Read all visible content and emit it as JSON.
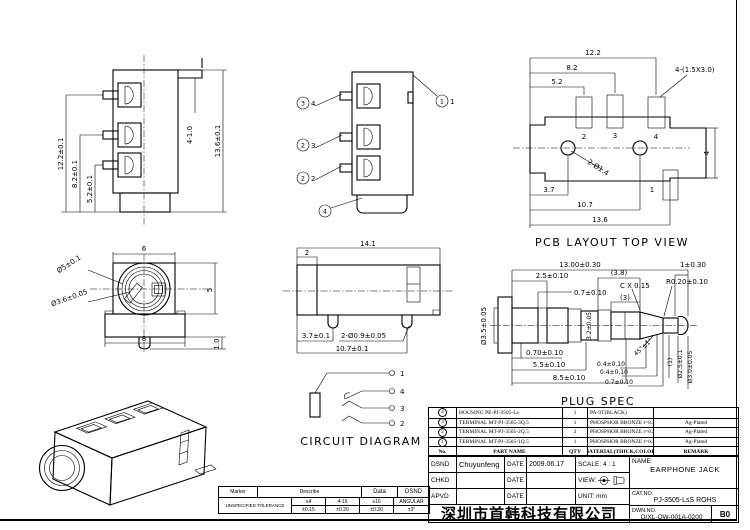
{
  "views": {
    "left": {
      "d_12_2": "12.2±0.1",
      "d_8_2": "8.2±0.1",
      "d_5_2": "5.2±0.1",
      "d_4_1": "4-1.0",
      "d_13_6": "13.6±0.1"
    },
    "open": {
      "pin_top_circle": "3",
      "pin_top": "4",
      "pin_mid_circle": "2",
      "pin_mid": "3",
      "pin_bot_circle": "2",
      "pin_bot": "2",
      "pin_housing_circle": "4",
      "pin_sleeve_circle": "1",
      "pin_sleeve": "1"
    },
    "pcb": {
      "title": "PCB LAYOUT TOP VIEW",
      "d_12_2": "12.2",
      "d_8_2": "8.2",
      "d_5_2": "5.2",
      "slot_note": "4-(1.5X3.0)",
      "hole_note": "2-Ø1.4",
      "d_4": "4",
      "d_3_7": "3.7",
      "d_10_7": "10.7",
      "d_13_6": "13.6",
      "pad_2": "2",
      "pad_3": "3",
      "pad_4": "4",
      "pad_1": "1"
    },
    "front": {
      "d_6": "6",
      "d_8": "8",
      "d_dia5": "Ø5±0.1",
      "d_dia36": "Ø3.6±0.05",
      "d_5": "5",
      "d_1": "1.0"
    },
    "side": {
      "d_14_1": "14.1",
      "d_2": "2",
      "d_3_7": "3.7±0.1",
      "d_holes": "2-Ø0.9±0.05",
      "d_10_7": "10.7±0.1"
    },
    "plug": {
      "title": "PLUG SPEC",
      "d_len": "13.00±0.30",
      "d_2_5": "2.5±0.10",
      "d_0_7t": "0.7±0.10",
      "d_3_8": "(3.8)",
      "d_cx": "C X 0.15",
      "d_3": "(3)",
      "d_r": "R0.20±0.10",
      "d_1": "1±0.30",
      "d_dia35": "Ø3.5±0.05",
      "d_3_2": "3.2±0.05",
      "d_070": "0.70±0.10",
      "d_5_5": "5.5±0.10",
      "d_8_5": "8.5±0.10",
      "d_angle": "45°±1°",
      "d_04a": "0.4±0.10",
      "d_04b": "0.4±0.10",
      "d_07b": "0.7±0.10",
      "d_p1": "(1)",
      "d_dia25": "Ø2.5±0.1",
      "d_dia30": "Ø3.0±0.05"
    },
    "circuit": {
      "title": "CIRCUIT DIAGRAM",
      "t1": "1",
      "t2": "4",
      "t3": "3",
      "t4": "2"
    }
  },
  "parts": {
    "headers": {
      "no": "No.",
      "name": "PART NAME",
      "qty": "QTY",
      "material": "MATERIAL(THICK,COLOR)",
      "remark": "REMARK"
    },
    "rows": [
      {
        "no": "4",
        "name": "HOUSING  PE-PJ-3505-Ls",
        "qty": "1",
        "material": "PA-9T(BLACK)",
        "remark": ""
      },
      {
        "no": "3",
        "name": "TERMINAL MT-PJ-3505-3Q.5",
        "qty": "1",
        "material": "PHOSPHOR BRONZE t=0.25",
        "remark": "Ag-Plated"
      },
      {
        "no": "2",
        "name": "TERMINAL MT-PJ-3505-2Q.5",
        "qty": "2",
        "material": "PHOSPHOR BRONZE t=0.25",
        "remark": "Ag-Plated"
      },
      {
        "no": "1",
        "name": "TERMINAL MT-PJ-3505-1Q.5",
        "qty": "1",
        "material": "PHOSPHOR BRONZE t=0.25",
        "remark": "Ag-Plated"
      }
    ]
  },
  "title_block": {
    "dsnd_label": "DSND",
    "dsnd_value": "Chuyunfeng",
    "chkd_label": "CHKD",
    "apvd_label": "APVD",
    "date_label": "DATE",
    "date_value": "2009.06.17",
    "scale_label": "SCALE:",
    "scale_value": "4 : 1",
    "view_label": "VIEW:",
    "unit_label": "UNIT:",
    "unit_value": "mm",
    "name_label": "NAME:",
    "name_value": "EARPHONE JACK",
    "catno_label": "CAT.NO.",
    "catno_value": "PJ-3505-LsS  ROHS",
    "dwnno_label": "DWN.NO.",
    "dwnno_value": "Q/XL-QW-001A-0200",
    "rev": "B0",
    "company": "深圳市首韩科技有限公司"
  },
  "tolerance": {
    "marker": "Marker",
    "describe": "Describe",
    "data": "Data",
    "dsnd": "DSND",
    "unspecified": "UNSPECIFIED TOLERANCE",
    "cols": [
      {
        "h": "≤4",
        "v": "±0.15"
      },
      {
        "h": "4-16",
        "v": "±0.20"
      },
      {
        "h": "≥16",
        "v": "±0.30"
      },
      {
        "h": "ANGULAR",
        "v": "±3°"
      }
    ]
  }
}
